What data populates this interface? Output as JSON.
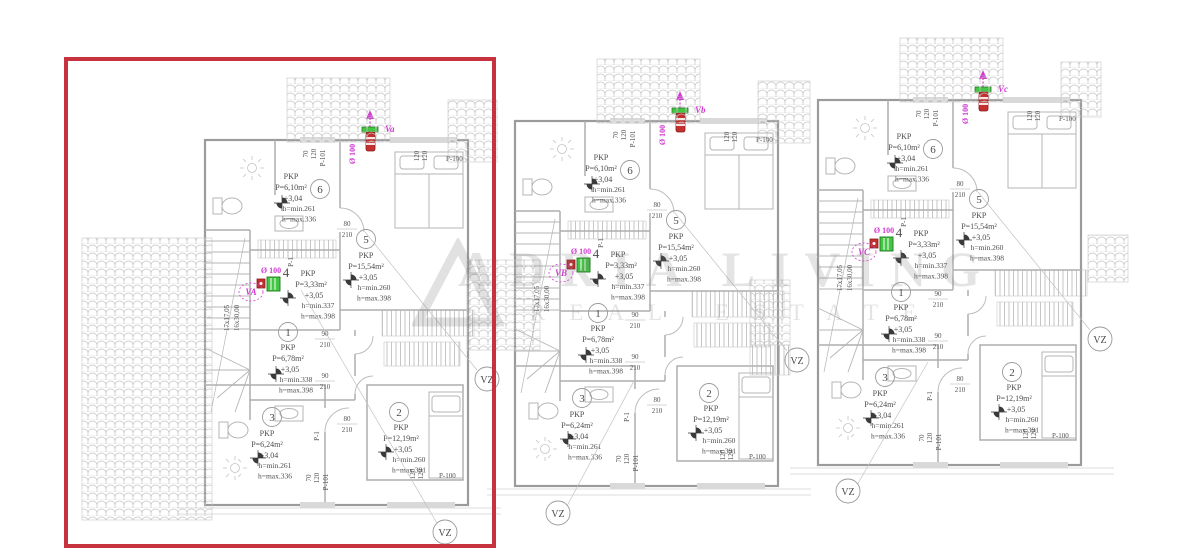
{
  "watermark": {
    "line1": "ADRIA LIVING",
    "line2": "REAL ESTATE"
  },
  "highlight_color": "#c8323f",
  "plan_common": {
    "rooms": [
      {
        "num": "1",
        "type": "PKP",
        "area": "P=6,78m²",
        "level": "+3,05",
        "hmin": "h=min.338",
        "hmax": "h=max.398"
      },
      {
        "num": "2",
        "type": "PKP",
        "area": "P=12,19m²",
        "level": "+3,05",
        "hmin": "h=min.260",
        "hmax": "h=max.391"
      },
      {
        "num": "3",
        "type": "PKP",
        "area": "P=6,24m²",
        "level": "+3,04",
        "hmin": "h=min.261",
        "hmax": "h=max.336"
      },
      {
        "num": "4",
        "type": "PKP",
        "area": "P=3,33m²",
        "level": "+3,05",
        "hmin": "h=min.337",
        "hmax": "h=max.398"
      },
      {
        "num": "5",
        "type": "PKP",
        "area": "P=15,54m²",
        "level": "+3,05",
        "hmin": "h=min.260",
        "hmax": "h=max.398"
      },
      {
        "num": "6",
        "type": "PKP",
        "area": "P=6,10m²",
        "level": "+3,04",
        "hmin": "h=min.261",
        "hmax": "h=max.336"
      }
    ],
    "dims": {
      "door80": "80",
      "door90": "90",
      "h210": "210",
      "w70": "70",
      "w120": "120",
      "p100": "P-100",
      "p101": "P-101",
      "p1": "P-1",
      "stair1": "17x17,05",
      "stair2": "16x30,00",
      "diam": "Ø 100",
      "vz": "VZ"
    }
  },
  "plans": [
    {
      "name": "left",
      "vent_top": "Va",
      "vent_room": "VA",
      "highlighted": true
    },
    {
      "name": "middle",
      "vent_top": "Vb",
      "vent_room": "VB",
      "highlighted": false
    },
    {
      "name": "right",
      "vent_top": "Vc",
      "vent_room": "VC",
      "highlighted": false
    }
  ]
}
